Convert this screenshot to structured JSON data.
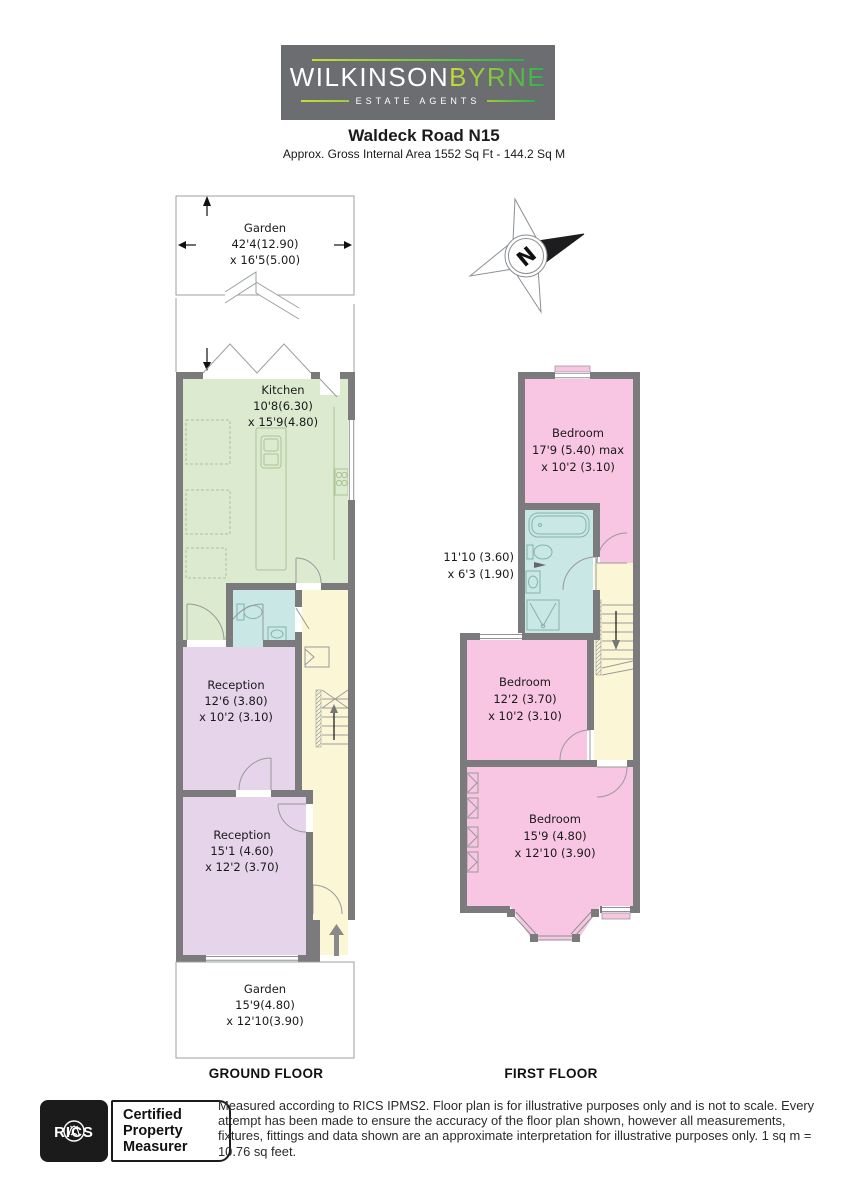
{
  "header": {
    "brand_part1": "WILKINSON",
    "brand_part2": "BYRNE",
    "brand_sub": "ESTATE AGENTS",
    "title": "Waldeck Road N15",
    "subtitle": "Approx. Gross Internal Area 1552 Sq Ft - 144.2 Sq M"
  },
  "compass": {
    "letter": "N"
  },
  "floors": {
    "ground": {
      "label": "GROUND FLOOR",
      "garden_top": {
        "name": "Garden",
        "dim1": "42'4(12.90)",
        "dim2": "x 16'5(5.00)"
      },
      "kitchen": {
        "name": "Kitchen",
        "dim1": "10'8(6.30)",
        "dim2": "x 15'9(4.80)"
      },
      "reception1": {
        "name": "Reception",
        "dim1": "12'6 (3.80)",
        "dim2": "x 10'2 (3.10)"
      },
      "reception2": {
        "name": "Reception",
        "dim1": "15'1 (4.60)",
        "dim2": "x 12'2 (3.70)"
      },
      "garden_bottom": {
        "name": "Garden",
        "dim1": "15'9(4.80)",
        "dim2": "x 12'10(3.90)"
      }
    },
    "first": {
      "label": "FIRST FLOOR",
      "bedroom1": {
        "name": "Bedroom",
        "dim1": "17'9 (5.40) max",
        "dim2": "x 10'2 (3.10)"
      },
      "bathroom": {
        "dim1": "11'10 (3.60)",
        "dim2": "x 6'3 (1.90)"
      },
      "bedroom2": {
        "name": "Bedroom",
        "dim1": "12'2 (3.70)",
        "dim2": "x 10'2 (3.10)"
      },
      "bedroom3": {
        "name": "Bedroom",
        "dim1": "15'9 (4.80)",
        "dim2": "x 12'10 (3.90)"
      }
    }
  },
  "footer": {
    "rics_word": "RICS",
    "cert_line1": "Certified",
    "cert_line2": "Property",
    "cert_line3": "Measurer",
    "disclaimer": "Measured according to RICS IPMS2. Floor plan is for illustrative purposes only and is not to scale. Every attempt has been made to ensure the accuracy of the floor plan shown, however all measurements, fixtures, fittings and data shown are an approximate interpretation for illustrative purposes only. 1 sq m = 10.76 sq feet."
  },
  "colors": {
    "wall": "#7b7b7e",
    "kitchen": "#dcead0",
    "bathroom": "#c9e7e4",
    "reception": "#e6d4eb",
    "bedroom": "#f8c6e2",
    "hall": "#fbf7d6",
    "logo_bg": "#6c6d70",
    "brand_yellow": "#c8dc35",
    "brand_green": "#2bb24c"
  }
}
